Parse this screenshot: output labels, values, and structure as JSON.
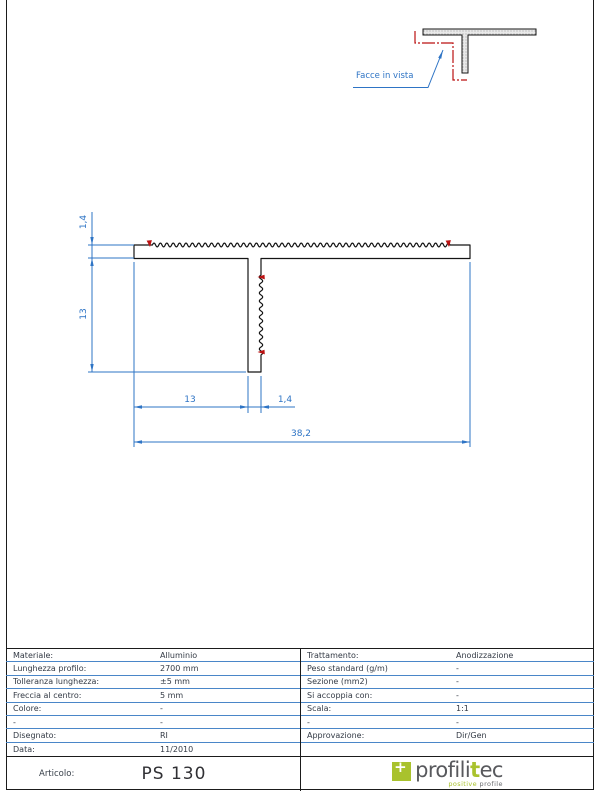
{
  "detail_view": {
    "label": "Facce in vista"
  },
  "dimensions": {
    "flange_thickness": "1,4",
    "stem_height": "13",
    "stem_offset": "13",
    "stem_thickness": "1,4",
    "total_width": "38,2"
  },
  "table": {
    "left": [
      {
        "label": "Materiale:",
        "value": "Alluminio"
      },
      {
        "label": "Lunghezza profilo:",
        "value": "2700 mm"
      },
      {
        "label": "Tolleranza lunghezza:",
        "value": "±5 mm"
      },
      {
        "label": "Freccia al centro:",
        "value": "5 mm"
      },
      {
        "label": "Colore:",
        "value": "-"
      },
      {
        "label": "-",
        "value": "-"
      },
      {
        "label": "Disegnato:",
        "value": "RI"
      },
      {
        "label": "Data:",
        "value": "11/2010"
      }
    ],
    "right": [
      {
        "label": "Trattamento:",
        "value": "Anodizzazione"
      },
      {
        "label": "Peso standard (g/m)",
        "value": "-"
      },
      {
        "label": "Sezione (mm2)",
        "value": "-"
      },
      {
        "label": "Si accoppia con:",
        "value": "-"
      },
      {
        "label": "Scala:",
        "value": "1:1"
      },
      {
        "label": "-",
        "value": "-"
      },
      {
        "label": "Approvazione:",
        "value": "Dir/Gen"
      },
      {
        "label": "",
        "value": ""
      }
    ],
    "articolo_label": "Articolo:",
    "articolo_value": "PS 130"
  },
  "logo": {
    "plus": "+",
    "part1": "profili",
    "t": "t",
    "part2": "ec",
    "tagline1": "positive",
    "tagline2": "profile"
  },
  "colors": {
    "dimension_blue": "#2e74c5",
    "table_line_blue": "#4a86c8",
    "face_marker_red": "#bb1111",
    "line_black": "#1b1b1b",
    "logo_green": "#a9c22d",
    "logo_gray": "#58595d"
  }
}
